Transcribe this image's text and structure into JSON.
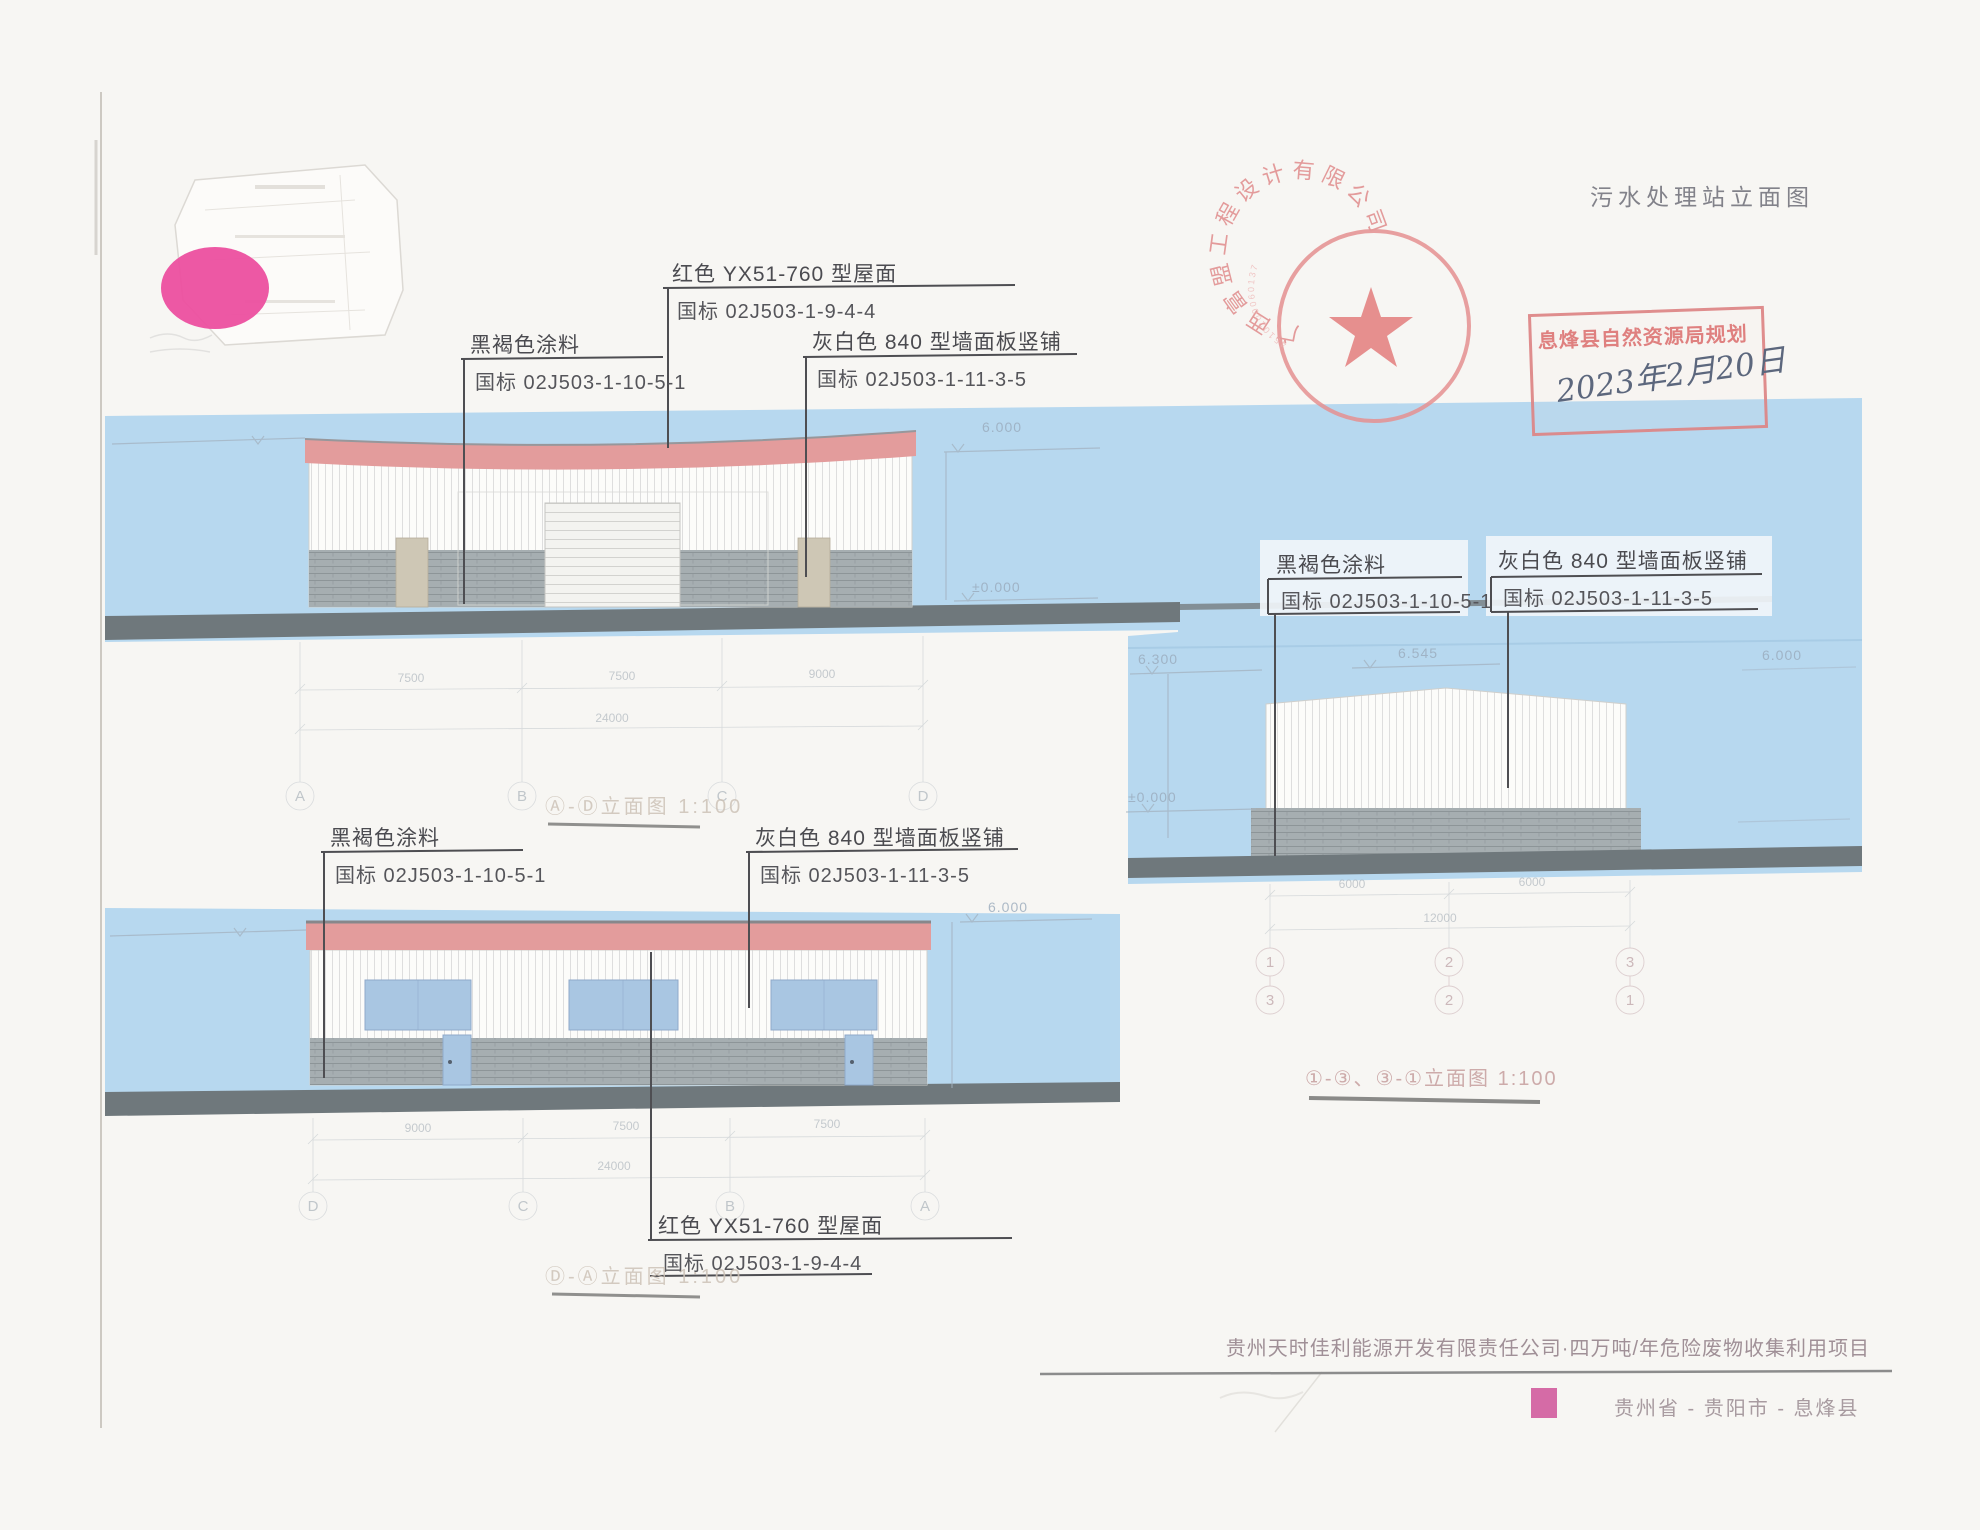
{
  "title": "污水处理站立面图",
  "seal": {
    "ring_text": "广西富盟工程设计有限公司",
    "serial": "4510200060137"
  },
  "approval_stamp": {
    "text": "息烽县自然资源局规划",
    "date": "2023年2月20日"
  },
  "callouts": {
    "roof": {
      "material": "红色 YX51-760 型屋面",
      "standard": "国标 02J503-1-9-4-4"
    },
    "paint": {
      "material": "黑褐色涂料",
      "standard": "国标 02J503-1-10-5-1"
    },
    "panel": {
      "material": "灰白色 840 型墙面板竖铺",
      "standard": "国标 02J503-1-11-3-5"
    }
  },
  "elevation_ad": {
    "caption": "Ⓐ-Ⓓ立面图 1:100",
    "grid": [
      "A",
      "B",
      "C",
      "D"
    ],
    "dims": [
      "7500",
      "7500",
      "9000"
    ],
    "total": "24000",
    "level_top": "6.000",
    "level_ground": "±0.000"
  },
  "elevation_da": {
    "caption": "Ⓓ-Ⓐ立面图 1:100",
    "grid": [
      "D",
      "C",
      "B",
      "A"
    ],
    "dims": [
      "9000",
      "7500",
      "7500"
    ],
    "total": "24000",
    "level_top": "6.000"
  },
  "elevation_13": {
    "caption": "①-③、③-①立面图 1:100",
    "grid_top": [
      "1",
      "2",
      "3"
    ],
    "grid_bottom": [
      "3",
      "2",
      "1"
    ],
    "dims": [
      "6000",
      "6000"
    ],
    "total": "12000",
    "level_left_top": "6.300",
    "level_peak": "6.545",
    "level_ground": "±0.000",
    "level_right_top": "6.000"
  },
  "footer": {
    "project": "贵州天时佳利能源开发有限责任公司·四万吨/年危险废物收集利用项目",
    "location": "贵州省 - 贵阳市 - 息烽县"
  },
  "colors": {
    "band_blue": "#b7d8ef",
    "roof_pink": "#e39c9c",
    "ground_gray": "#6f787c",
    "accent_magenta": "#ec4f9f",
    "stamp_red": "#dd8585",
    "footer_pink_square": "#d56ba6"
  }
}
